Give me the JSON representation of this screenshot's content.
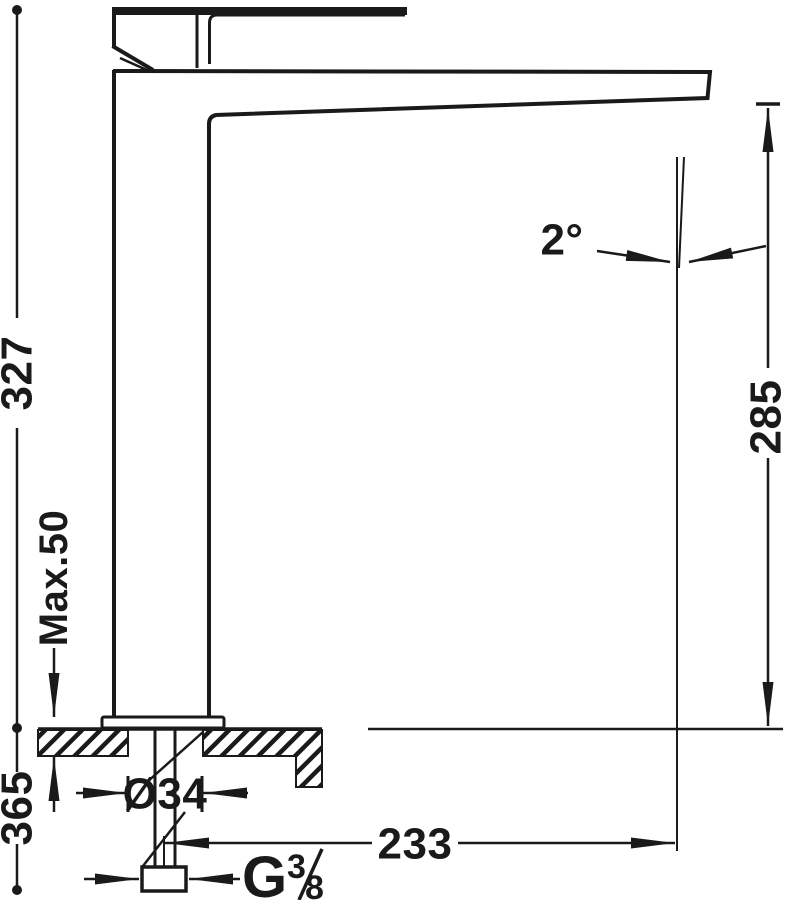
{
  "drawing": {
    "colors": {
      "ink": "#1a1a1a",
      "background": "#ffffff"
    },
    "dimensions": {
      "overall_height": "327",
      "below_deck_depth": "365",
      "max_deck_thickness": "Max.50",
      "base_diameter": "Ø34",
      "spout_reach": "233",
      "spout_outlet_height": "285",
      "spout_angle": "2°",
      "thread": {
        "letter": "G",
        "numerator": "3",
        "denominator": "8"
      }
    }
  }
}
